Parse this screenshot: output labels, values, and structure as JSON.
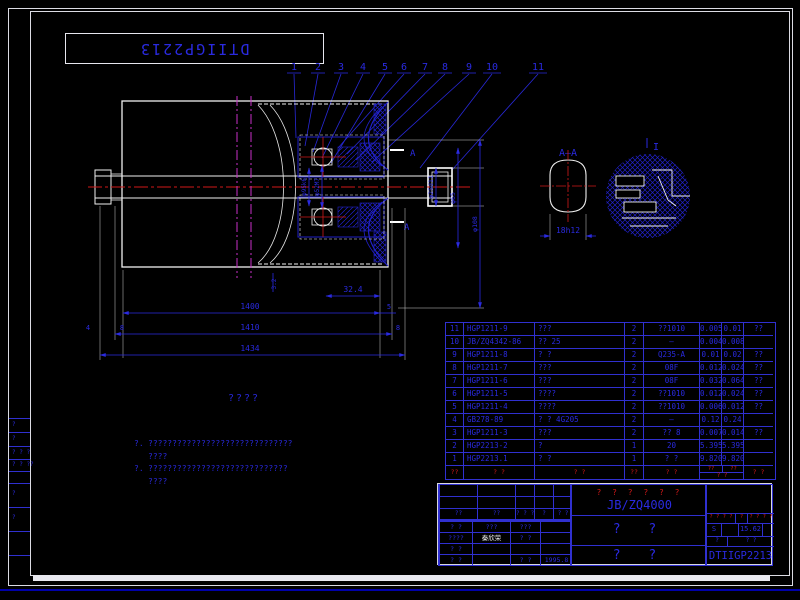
{
  "stamp": {
    "code": "DTIIGP2213"
  },
  "callouts": {
    "labels": [
      "1",
      "2",
      "3",
      "4",
      "5",
      "6",
      "7",
      "8",
      "9",
      "10",
      "11"
    ]
  },
  "drawing": {
    "section_label": "A—A",
    "section_mark": "A",
    "detail_label": "I",
    "dims": {
      "d1": "φ95k6",
      "d2": "φ52M7",
      "d3": "φ25d11",
      "d4": "φ65",
      "d5": "φ108",
      "len1": "1400",
      "len2": "1410",
      "len3": "1434",
      "seg": "32.4",
      "t1": "5",
      "t2": "8",
      "t3": "8",
      "t4": "4",
      "t5": "3.2",
      "flat": "18h12"
    }
  },
  "notes": {
    "title": "????",
    "item1_no": "?.",
    "item1_line1": "??????????????????????????????",
    "item1_line2": "????",
    "item2_no": "?.",
    "item2_line1": "?????????????????????????????",
    "item2_line2": "????"
  },
  "bom": {
    "header": {
      "no": "??",
      "code": "? ?",
      "name": "? ?",
      "qty": "??",
      "material": "? ?",
      "w_unit": "??",
      "w_total": "??",
      "w_label": "? ?",
      "remarks": "? ?"
    },
    "rows": [
      {
        "no": "11",
        "code": "HGP1211-9",
        "name": "???",
        "qty": "2",
        "material": "??1010",
        "unit": "0.005",
        "total": "0.01",
        "remarks": "??"
      },
      {
        "no": "10",
        "code": "JB/ZQ4342-86",
        "name": "?? 25",
        "qty": "2",
        "material": "—",
        "unit": "0.004",
        "total": "0.008",
        "remarks": ""
      },
      {
        "no": "9",
        "code": "HGP1211-8",
        "name": "? ?",
        "qty": "2",
        "material": "Q235-A",
        "unit": "0.01",
        "total": "0.02",
        "remarks": "??"
      },
      {
        "no": "8",
        "code": "HGP1211-7",
        "name": "???",
        "qty": "2",
        "material": "08F",
        "unit": "0.012",
        "total": "0.024",
        "remarks": "??"
      },
      {
        "no": "7",
        "code": "HGP1211-6",
        "name": "???",
        "qty": "2",
        "material": "08F",
        "unit": "0.032",
        "total": "0.064",
        "remarks": "??"
      },
      {
        "no": "6",
        "code": "HGP1211-5",
        "name": "????",
        "qty": "2",
        "material": "??1010",
        "unit": "0.012",
        "total": "0.024",
        "remarks": "??"
      },
      {
        "no": "5",
        "code": "HGP1211-4",
        "name": "????",
        "qty": "2",
        "material": "??1010",
        "unit": "0.006",
        "total": "0.012",
        "remarks": "??"
      },
      {
        "no": "4",
        "code": "GB278-89",
        "name": "? ? 4G205",
        "qty": "2",
        "material": "—",
        "unit": "0.12",
        "total": "0.24",
        "remarks": ""
      },
      {
        "no": "3",
        "code": "HGP1211-3",
        "name": "???",
        "qty": "2",
        "material": "?? 8",
        "unit": "0.007",
        "total": "0.014",
        "remarks": "??"
      },
      {
        "no": "2",
        "code": "HGP2213-2",
        "name": "?",
        "qty": "1",
        "material": "20",
        "unit": "5.395",
        "total": "5.395",
        "remarks": ""
      },
      {
        "no": "1",
        "code": "HGP2213.1",
        "name": "? ?",
        "qty": "1",
        "material": "? ?",
        "unit": "9.820",
        "total": "9.820",
        "remarks": ""
      }
    ]
  },
  "titleblock": {
    "rev_row": [
      "??",
      "??",
      "? ? ?",
      "?",
      "? ?"
    ],
    "sig": [
      {
        "c1": "? ?",
        "c2": "???",
        "c3": "???",
        "c4": ""
      },
      {
        "c1": "????",
        "c2": "秦欣荣",
        "c3": "? ?",
        "c4": ""
      },
      {
        "c1": "? ?",
        "c2": "",
        "c3": "",
        "c4": ""
      },
      {
        "c1": "? ?",
        "c2": "",
        "c3": "? ?",
        "c4": "1995.8"
      }
    ],
    "product_red": "? ? ? ? ? ?",
    "standard": "JB/ZQ4000",
    "mid1": "? ?",
    "mid2": "? ?",
    "right_red_1": "? ? ? ?",
    "right_red_2": "?",
    "right_red_3": "? ? ? ?",
    "scale_mark": "S",
    "weight": "15.62",
    "row3a": "?",
    "row3b": "? ?",
    "code": "DTIIGP2213"
  },
  "edge": {
    "marks": [
      "?",
      "?",
      "? ? ?",
      "? ? ??",
      "?",
      "?"
    ]
  }
}
